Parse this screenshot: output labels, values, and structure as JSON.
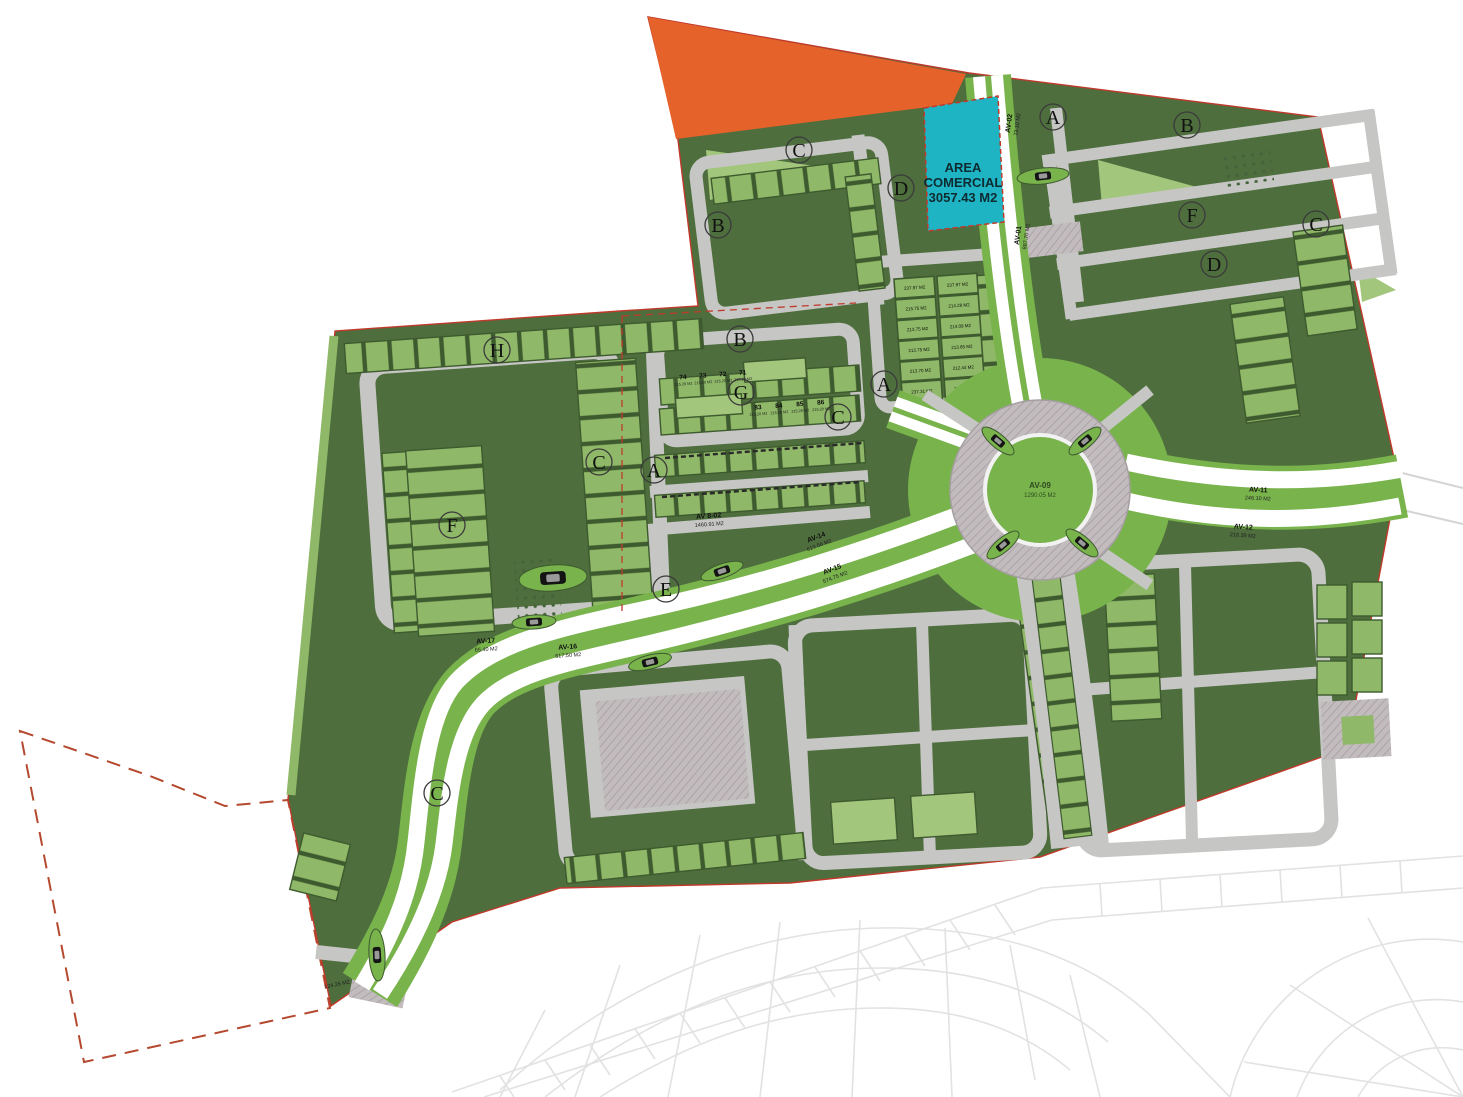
{
  "title": "Plano de lotificacion - master plan",
  "colors": {
    "dark_green": "#4e6e3d",
    "lot_green": "#8fb968",
    "park_green": "#a3c67d",
    "median_green": "#79b34c",
    "road_gray": "#c6c6c4",
    "asphalt_white": "#ffffff",
    "reserve_orange": "#e5622a",
    "commercial_cyan": "#1fb4c4",
    "boundary_red": "#c0392b",
    "ghost_gray": "#e2e2e2"
  },
  "commercial": {
    "line1": "AREA",
    "line2": "COMERCIAL",
    "line3": "3057.43 M2"
  },
  "roundabout": {
    "name": "AV-09",
    "area": "1290.05 M2"
  },
  "letters": [
    {
      "t": "H"
    },
    {
      "t": "B"
    },
    {
      "t": "C"
    },
    {
      "t": "D"
    },
    {
      "t": "A"
    },
    {
      "t": "B"
    },
    {
      "t": "F"
    },
    {
      "t": "C"
    },
    {
      "t": "D"
    },
    {
      "t": "B"
    },
    {
      "t": "G"
    },
    {
      "t": "A"
    },
    {
      "t": "C"
    },
    {
      "t": "A"
    },
    {
      "t": "F"
    },
    {
      "t": "C"
    },
    {
      "t": "E"
    },
    {
      "t": "C"
    }
  ],
  "roads": [
    {
      "name": "AV-01",
      "area": "887.70 M2"
    },
    {
      "name": "AV-02",
      "area": "73.10 M2"
    },
    {
      "name": "AV-11",
      "area": "246.10 M2"
    },
    {
      "name": "AV-12",
      "area": "218.39 M2"
    },
    {
      "name": "AV-14",
      "area": "619.56 M2"
    },
    {
      "name": "AV-15",
      "area": "574.75 M2"
    },
    {
      "name": "AV-17",
      "area": "65.40 M2"
    },
    {
      "name": "AV-16",
      "area": "617.50 M2"
    },
    {
      "name": "AV 8-02",
      "area": "1460.91 M2"
    },
    {
      "name": "",
      "area": "124.26 M2"
    }
  ],
  "lot_grid": {
    "values": [
      "237.97 M2",
      "237.97 M2",
      "215.75 M2",
      "214.28 M2",
      "213.75 M2",
      "214.09 M2",
      "213.75 M2",
      "213.65 M2",
      "213.70 M2",
      "212.44 M2",
      "237.31 M2",
      "235.09 M2"
    ]
  },
  "lot_numbers": {
    "top": [
      {
        "n": "74",
        "a": "215.20 M2"
      },
      {
        "n": "73",
        "a": "215.20 M2"
      },
      {
        "n": "72",
        "a": "215.20 M2"
      },
      {
        "n": "71",
        "a": "215.20 M2"
      }
    ],
    "bottom": [
      {
        "n": "83",
        "a": "215.20 M2"
      },
      {
        "n": "84",
        "a": "215.20 M2"
      },
      {
        "n": "85",
        "a": "215.20 M2"
      },
      {
        "n": "86",
        "a": "215.20 M2"
      }
    ]
  }
}
